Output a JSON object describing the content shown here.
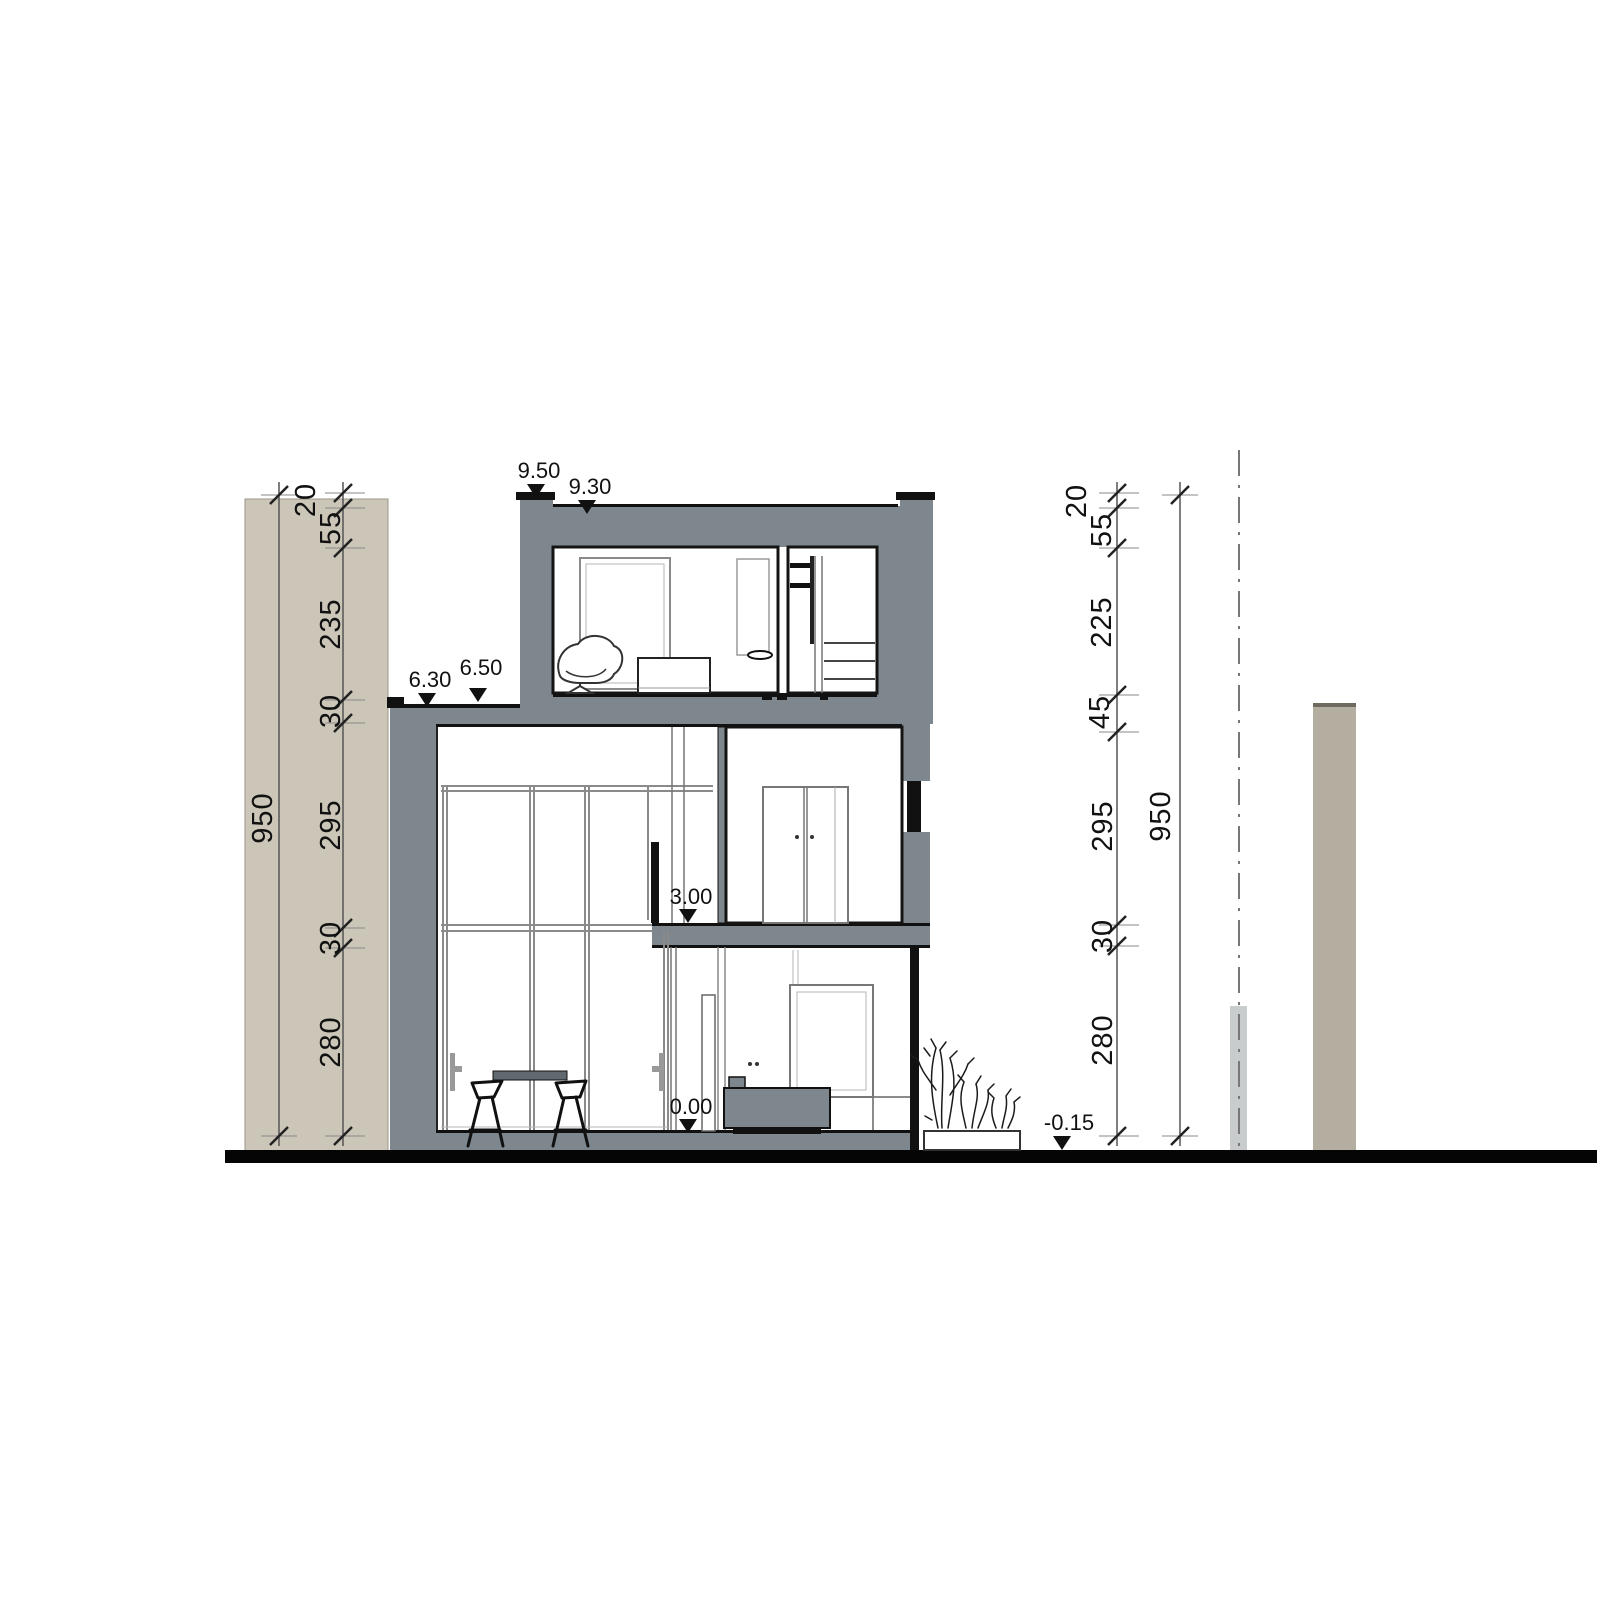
{
  "drawing": {
    "title": "residential building cross-section",
    "levels": {
      "roof_parapet": "9.50",
      "roof_surface": "9.30",
      "annex_roof": "6.30",
      "upper_floor": "6.50",
      "first_floor": "3.00",
      "ground_floor": "0.00",
      "terrain": "-0.15"
    },
    "dim_left": {
      "segments": [
        "20",
        "55",
        "235",
        "30",
        "295",
        "30",
        "280"
      ],
      "total": "950"
    },
    "dim_right": {
      "segments": [
        "20",
        "55",
        "225",
        "45",
        "295",
        "30",
        "280"
      ],
      "total": "950"
    },
    "colors": {
      "wall": "#7e878d",
      "furniture_gray": "#5f696f",
      "neighbor_left": "#cbc6b8",
      "neighbor_right": "#b4aea1",
      "boundary_post": "#c8cccc",
      "ground": "#050505",
      "paper": "#ffffff"
    }
  }
}
